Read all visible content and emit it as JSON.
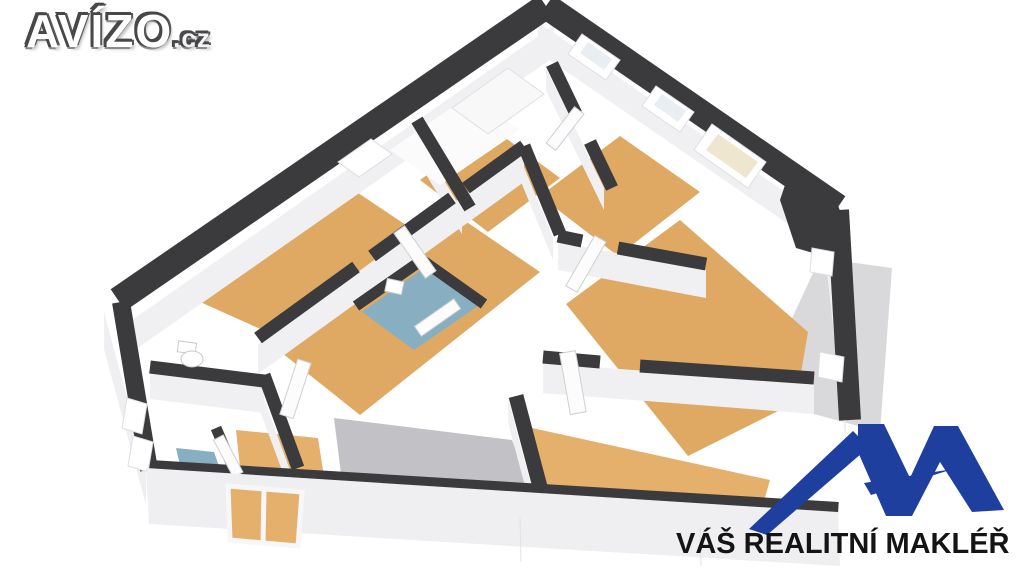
{
  "branding": {
    "site_logo_text": "AVÍZO",
    "site_logo_suffix": ".cz",
    "agent_tagline": "VÁŠ REALITNÍ MAKLÉŘ"
  },
  "icons": {
    "agent_logo": "mountain-peaks-logo"
  },
  "colors": {
    "wall-dark": "#3b3b3d",
    "wall-face": "#f0f0f2",
    "wall-bright": "#fbfbfc",
    "floor-tan": "#dfa963",
    "floor-tan-light": "#e4b06c",
    "floor-blue": "#87afc1",
    "floor-gray": "#c2c2c6",
    "terrace": "#d9d9db",
    "skirt": "#efeff1",
    "logo-blue": "#1e3f9e",
    "logo-text": "#141414",
    "avizo-outline": "#47474a"
  }
}
